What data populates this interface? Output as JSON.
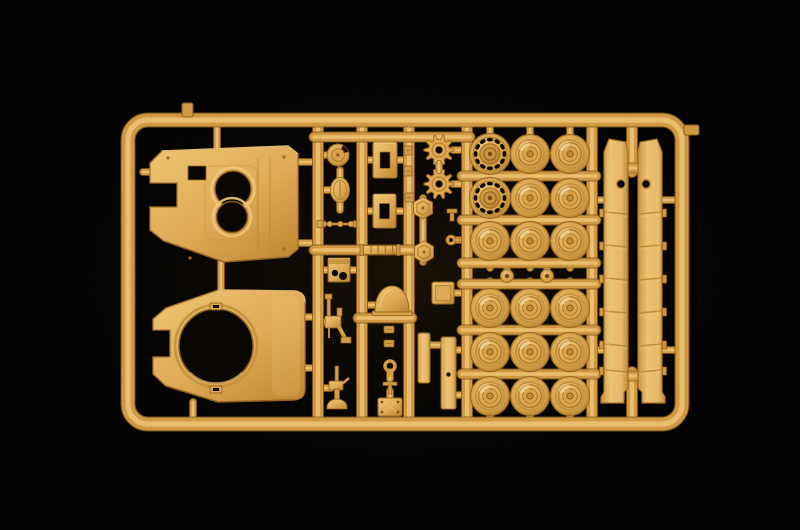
{
  "scene": {
    "type": "photograph",
    "subject": "Tan injection-molded plastic model kit sprue with tank parts photographed on a black background",
    "background_color": "#000000"
  },
  "palette": {
    "plastic_base": "#DFA84F",
    "plastic_light": "#F1C87E",
    "plastic_mid": "#CF9740",
    "plastic_dark": "#B07C2B",
    "plastic_edge": "#8A5C1C",
    "hole_color": "#070402"
  },
  "sprue": {
    "frame": {
      "x": 128,
      "y": 120,
      "width": 554,
      "height": 304,
      "corner_radius": 20,
      "rail_width": 13
    },
    "gate_stubs": [
      {
        "x": 182,
        "y": 103,
        "width": 11,
        "height": 14
      },
      {
        "x": 684,
        "y": 125,
        "width": 15,
        "height": 10
      }
    ],
    "vertical_runners": [
      318,
      362,
      409,
      467,
      592
    ],
    "skirt_runner_segments": [
      {
        "x": 632,
        "y1": 124,
        "y2": 172
      },
      {
        "x": 632,
        "y1": 372,
        "y2": 420
      }
    ],
    "cross_runners": [
      {
        "y": 137,
        "x1": 314,
        "x2": 470
      },
      {
        "y": 250,
        "x1": 314,
        "x2": 412
      },
      {
        "y": 318,
        "x1": 358,
        "x2": 412
      },
      {
        "y": 176,
        "x1": 462,
        "x2": 596
      },
      {
        "y": 220,
        "x1": 462,
        "x2": 596
      },
      {
        "y": 263,
        "x1": 462,
        "x2": 596
      },
      {
        "y": 284,
        "x1": 462,
        "x2": 596
      },
      {
        "y": 330,
        "x1": 462,
        "x2": 596
      },
      {
        "y": 374,
        "x1": 462,
        "x2": 596
      },
      {
        "y": 168,
        "x1": 610,
        "x2": 656
      },
      {
        "y": 376,
        "x1": 610,
        "x2": 656
      }
    ],
    "stubs": [
      [
        217,
        126,
        217,
        148
      ],
      [
        298,
        162,
        312,
        162
      ],
      [
        298,
        243,
        312,
        243
      ],
      [
        143,
        172,
        152,
        172
      ],
      [
        221,
        262,
        221,
        292
      ],
      [
        305,
        317,
        313,
        317
      ],
      [
        305,
        368,
        313,
        368
      ],
      [
        193,
        402,
        193,
        417
      ],
      [
        323,
        155,
        329,
        155
      ],
      [
        340,
        170,
        340,
        179
      ],
      [
        324,
        190,
        332,
        190
      ],
      [
        340,
        203,
        340,
        210
      ],
      [
        362,
        160,
        373,
        160
      ],
      [
        397,
        160,
        409,
        160
      ],
      [
        362,
        211,
        373,
        211
      ],
      [
        396,
        211,
        409,
        211
      ],
      [
        318,
        224,
        323,
        224
      ],
      [
        355,
        224,
        362,
        224
      ],
      [
        323,
        270,
        329,
        270
      ],
      [
        350,
        270,
        362,
        270
      ],
      [
        323,
        322,
        327,
        322
      ],
      [
        323,
        388,
        331,
        388
      ],
      [
        368,
        305,
        376,
        305
      ],
      [
        406,
        305,
        409,
        305
      ],
      [
        385,
        137,
        385,
        143
      ],
      [
        390,
        372,
        390,
        379
      ],
      [
        390,
        391,
        390,
        397
      ],
      [
        439,
        140,
        439,
        190
      ],
      [
        453,
        150,
        462,
        150
      ],
      [
        453,
        184,
        462,
        184
      ],
      [
        414,
        208,
        418,
        208
      ],
      [
        414,
        252,
        418,
        252
      ],
      [
        423,
        198,
        423,
        262
      ],
      [
        452,
        240,
        462,
        240
      ],
      [
        454,
        293,
        462,
        293
      ],
      [
        430,
        345,
        441,
        345
      ],
      [
        456,
        350,
        462,
        350
      ],
      [
        456,
        395,
        462,
        395
      ],
      [
        507,
        263,
        507,
        284
      ],
      [
        547,
        263,
        547,
        284
      ],
      [
        592,
        200,
        604,
        200
      ],
      [
        592,
        350,
        604,
        350
      ],
      [
        660,
        200,
        675,
        200
      ],
      [
        660,
        350,
        675,
        350
      ],
      [
        628,
        162,
        638,
        162
      ]
    ],
    "parts": {
      "hull_top": {
        "rect_hole": {
          "x": 188,
          "y": 166,
          "w": 18,
          "h": 14
        },
        "hatch_holes": [
          {
            "x": 233,
            "y": 189,
            "r": 18
          },
          {
            "x": 232,
            "y": 217,
            "r": 15.5
          }
        ]
      },
      "turret_base": {
        "ring_hole": {
          "x": 216,
          "y": 346,
          "r": 37
        }
      },
      "side_skirts": {
        "count": 2,
        "ring_details": [
          {
            "x": 621,
            "y": 184
          },
          {
            "x": 646,
            "y": 184
          }
        ]
      },
      "road_wheels": {
        "count": 16,
        "radius": 19.5,
        "positions": [
          [
            530,
            154
          ],
          [
            570,
            154
          ],
          [
            530,
            198
          ],
          [
            570,
            198
          ],
          [
            490,
            241
          ],
          [
            530,
            241
          ],
          [
            570,
            241
          ],
          [
            490,
            308
          ],
          [
            530,
            308
          ],
          [
            570,
            308
          ],
          [
            490,
            352
          ],
          [
            530,
            352
          ],
          [
            570,
            352
          ],
          [
            490,
            396
          ],
          [
            530,
            396
          ],
          [
            570,
            396
          ]
        ]
      },
      "idler_wheels": {
        "count": 2,
        "radius": 20.5,
        "hole_count": 12,
        "positions": [
          [
            490,
            154
          ],
          [
            490,
            198
          ]
        ]
      },
      "drive_sprockets": {
        "count": 2,
        "radius": 15,
        "teeth": 10,
        "positions": [
          [
            439,
            150
          ],
          [
            439,
            184
          ]
        ]
      },
      "hub_caps": {
        "count": 2,
        "radius": 6.5,
        "positions": [
          [
            507,
            276
          ],
          [
            547,
            276
          ]
        ]
      },
      "small_parts": [
        {
          "type": "round-cupola",
          "x": 338,
          "y": 155,
          "r": 11
        },
        {
          "type": "oval-hatch",
          "x": 340,
          "y": 190,
          "rx": 9.5,
          "ry": 12.5
        },
        {
          "type": "antenna-rod",
          "x1": 321,
          "y": 224,
          "x2": 356
        },
        {
          "type": "ribbed-cylinder",
          "x1": 362,
          "y": 250,
          "len": 36
        },
        {
          "type": "equipment-box",
          "x": 328,
          "y": 258,
          "w": 22,
          "h": 24
        },
        {
          "type": "machine-gun",
          "x": 335,
          "y": 322
        },
        {
          "type": "pintle-mount",
          "x": 337,
          "y": 386
        },
        {
          "type": "rect-hatch",
          "x": 373,
          "y": 142,
          "w": 24,
          "h": 36
        },
        {
          "type": "rect-hatch",
          "x": 373,
          "y": 194,
          "w": 23,
          "h": 34
        },
        {
          "type": "dome-shield",
          "x": 392,
          "y": 300
        },
        {
          "type": "small-clip",
          "x": 384,
          "y": 326,
          "w": 10,
          "h": 7
        },
        {
          "type": "small-clip",
          "x": 384,
          "y": 340,
          "w": 10,
          "h": 7
        },
        {
          "type": "eyelet",
          "x": 390,
          "y": 366,
          "r": 5
        },
        {
          "type": "t-bracket",
          "x": 390,
          "y": 384
        },
        {
          "type": "riveted-plate",
          "x": 378,
          "y": 398,
          "w": 24,
          "h": 18
        },
        {
          "type": "small-clip",
          "x": 404,
          "y": 146,
          "w": 8,
          "h": 9
        },
        {
          "type": "small-clip",
          "x": 404,
          "y": 166,
          "w": 8,
          "h": 10
        },
        {
          "type": "small-clip",
          "x": 405,
          "y": 193,
          "w": 9,
          "h": 9
        },
        {
          "type": "hex-plate",
          "x": 423,
          "y": 208,
          "r": 11
        },
        {
          "type": "hex-plate",
          "x": 424,
          "y": 252,
          "r": 11
        },
        {
          "type": "small-fitting",
          "x": 452,
          "y": 214
        },
        {
          "type": "ring-fitting",
          "x": 451,
          "y": 240,
          "r": 5
        },
        {
          "type": "square-plate",
          "x": 432,
          "y": 282,
          "w": 22,
          "h": 22
        },
        {
          "type": "tall-plate",
          "x": 418,
          "y": 333,
          "w": 12,
          "h": 50,
          "hole": false
        },
        {
          "type": "tall-plate",
          "x": 441,
          "y": 337,
          "w": 15,
          "h": 72,
          "hole": true
        }
      ]
    }
  }
}
